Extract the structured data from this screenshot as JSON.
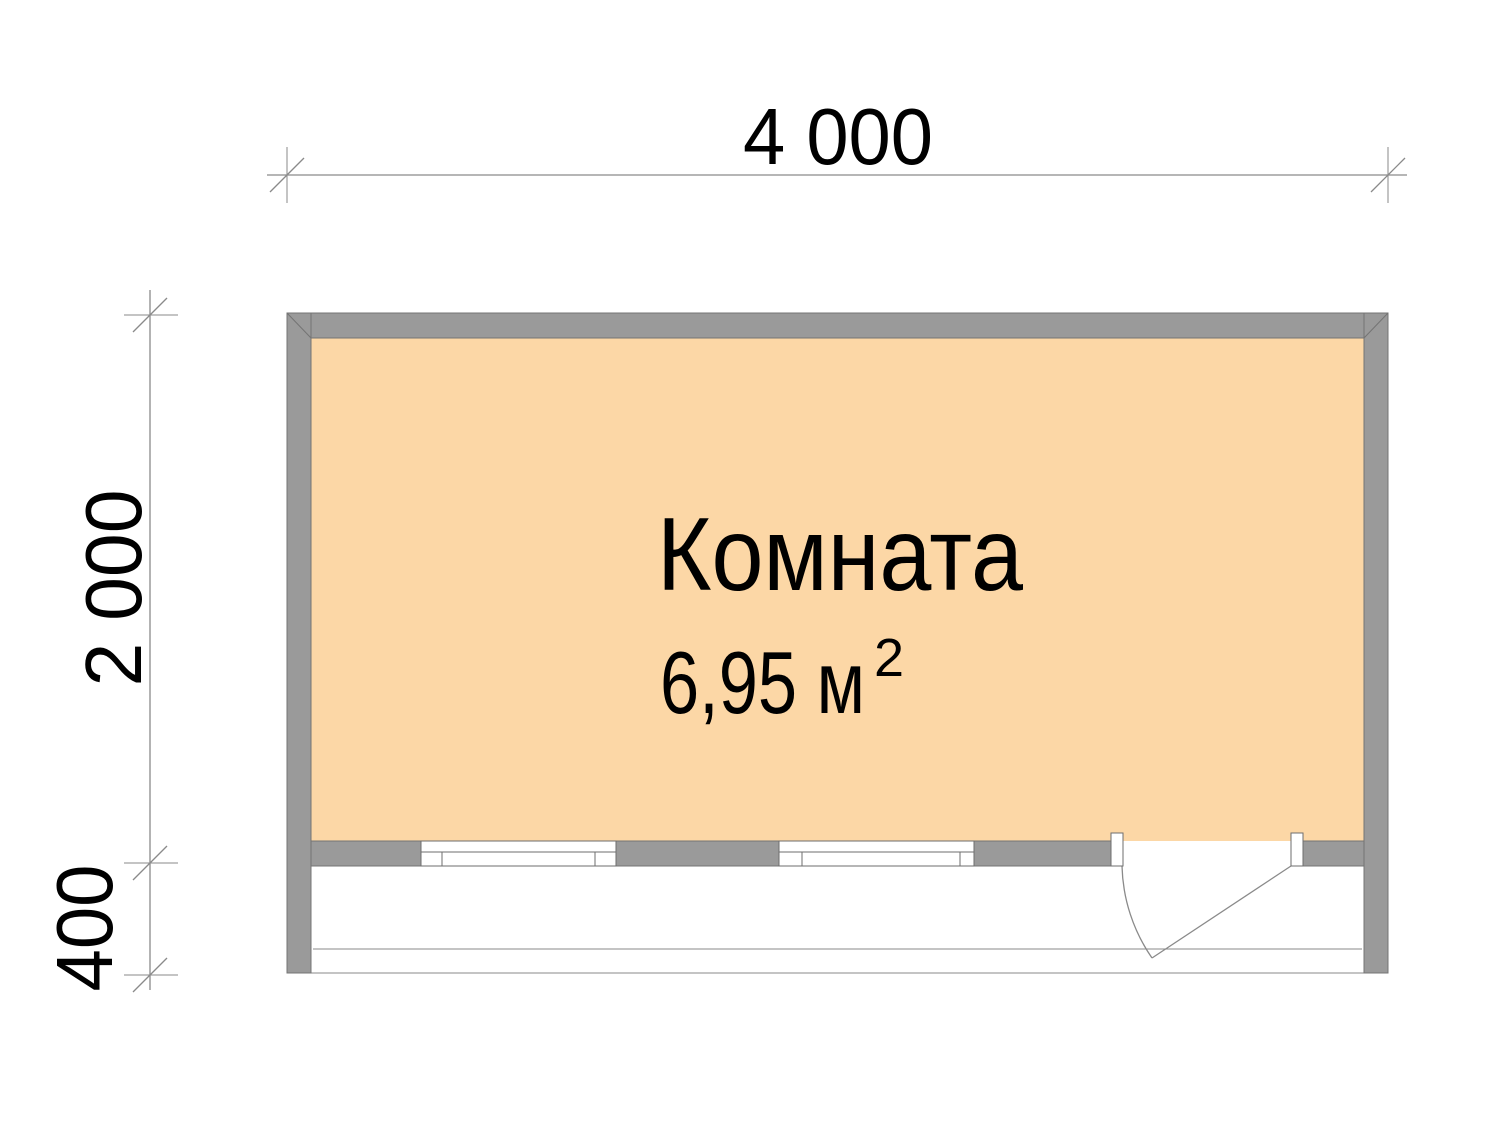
{
  "plan": {
    "room": {
      "name": "Комната",
      "area_text": "6,95 м",
      "area_superscript": "2"
    },
    "dimensions": {
      "width": "4 000",
      "height": "2 000",
      "porch_depth": "400"
    },
    "colors": {
      "background": "#FFFFFF",
      "room_fill": "#FCD7A6",
      "wall_fill": "#9A9A9A",
      "wall_stroke": "#747474",
      "frame_stroke": "#6E6E6E",
      "line": "#8A8A8A",
      "text": "#000000"
    }
  }
}
